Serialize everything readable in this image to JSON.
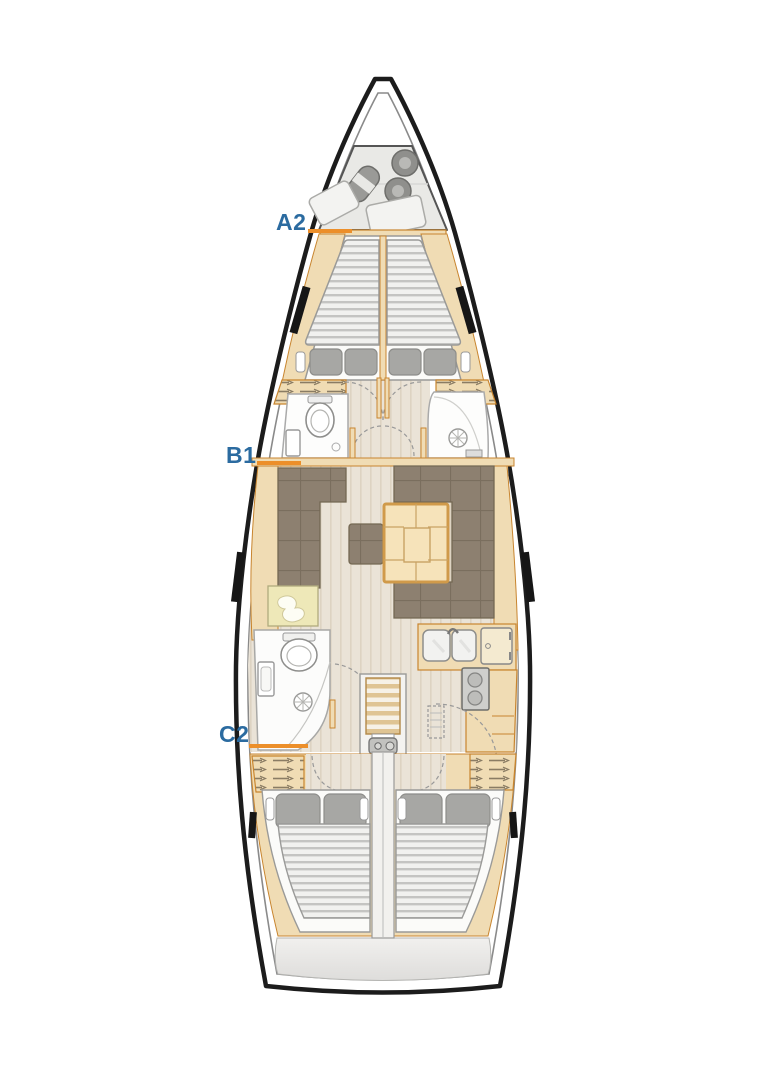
{
  "labels": {
    "a2": "A2",
    "b1": "B1",
    "c2": "C2"
  },
  "colors": {
    "label_text": "#2b6ba0",
    "leader_line": "#ec8f2a",
    "hull_outline": "#1c1c1c",
    "wood_trim": "#f0dcb4",
    "wood_border": "#c8852f",
    "upholstery": "#8d8070",
    "floor": "#eae3d7",
    "mattress": "#f1f1ef",
    "pillow": "#a7a7a4",
    "table_wood": "#f6e3ba"
  }
}
